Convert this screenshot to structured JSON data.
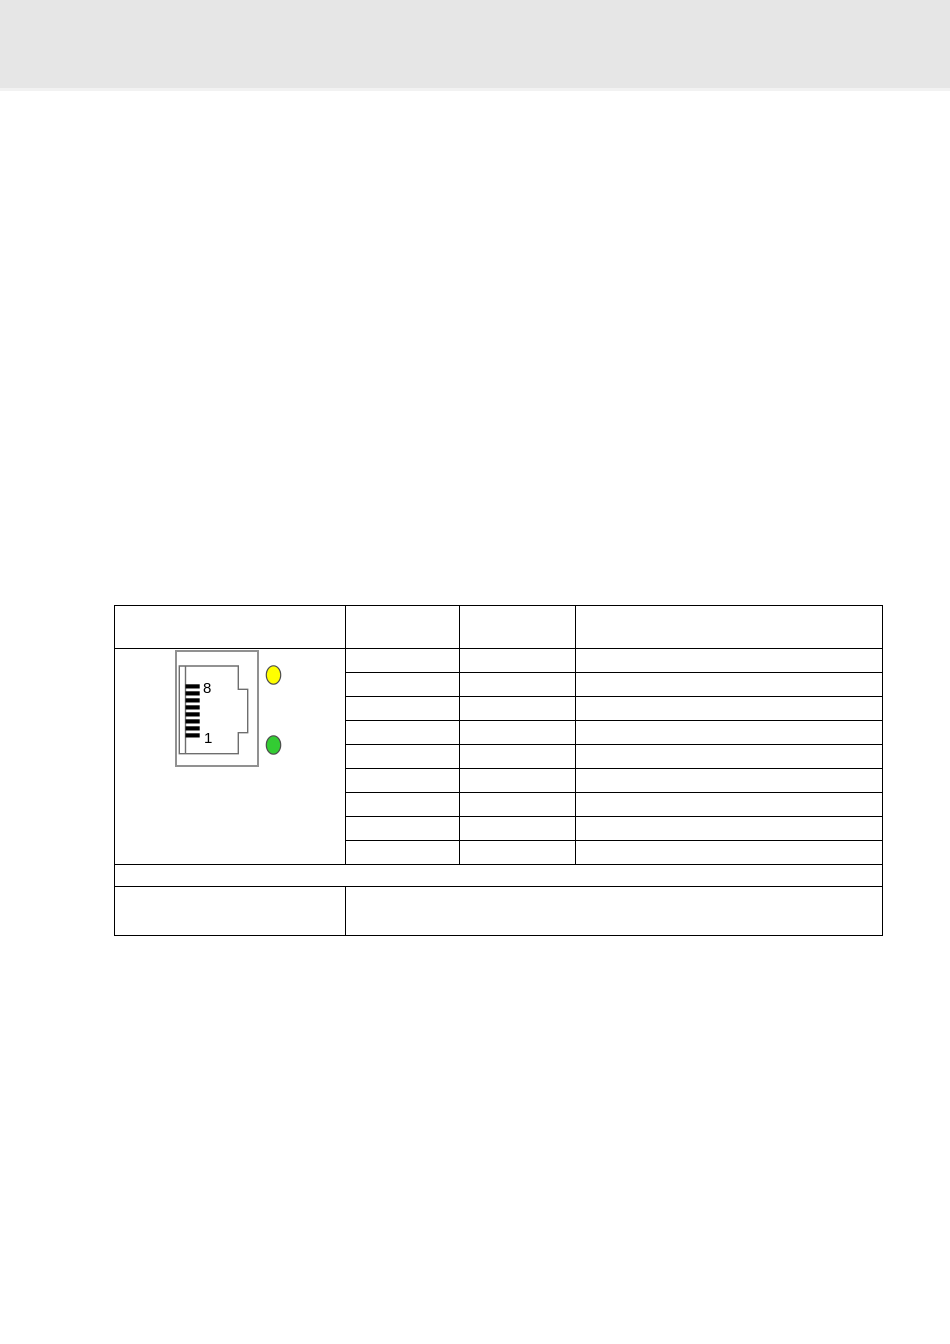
{
  "page": {
    "background_color": "#ffffff",
    "top_band": {
      "color": "#e6e6e6",
      "edge_color": "#f2f2f2"
    }
  },
  "table": {
    "border_color": "#000000",
    "header_cells": [
      "",
      "",
      "",
      ""
    ],
    "pin_rows": 9,
    "note_row_text": "",
    "footer_left_text": "",
    "footer_right_text": "",
    "connector": {
      "icon": "rj45-jack-side-view",
      "pin_count": 8,
      "pin_top_label": "8",
      "pin_bottom_label": "1",
      "housing_border_color": "#919191",
      "profile_line_color": "#6e6e6e",
      "pin_color": "#000000",
      "led_top_color": "#ffff00",
      "led_bottom_color": "#33cc33",
      "led_outline_color": "#4d4d4d"
    }
  }
}
